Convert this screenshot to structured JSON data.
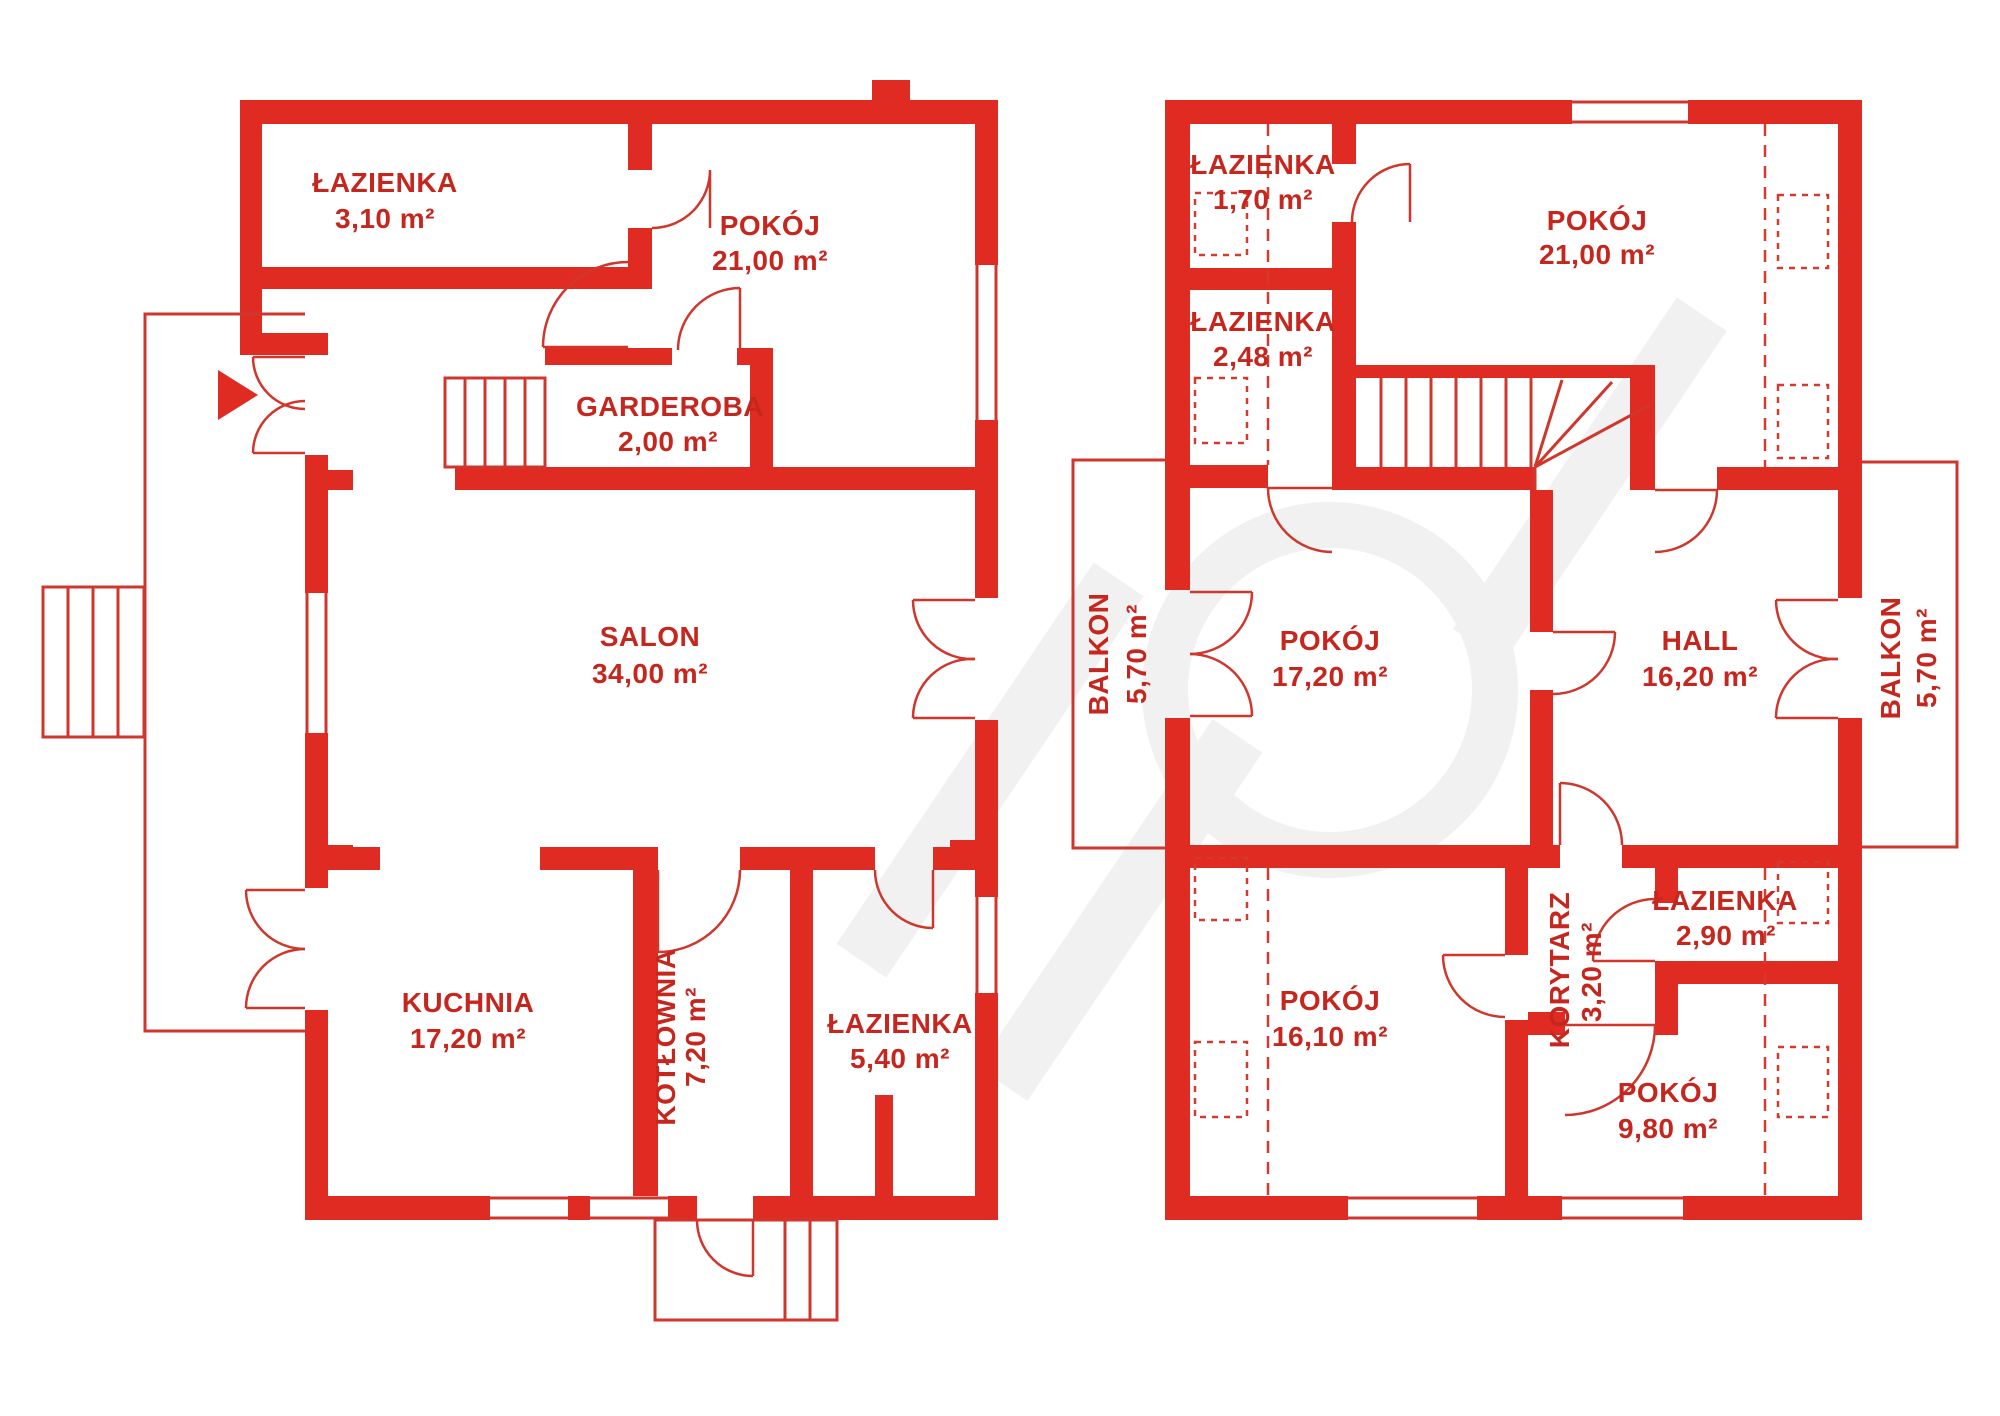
{
  "document": {
    "type": "floor-plan",
    "language": "pl"
  },
  "colors": {
    "wall": "#e02b22",
    "line": "#cf372d",
    "text": "#c5261e",
    "dashed": "#d43a30",
    "watermark": "#d9d9d9",
    "background": "#ffffff"
  },
  "floors": {
    "ground": {
      "rooms": {
        "lazienka_a": {
          "name": "ŁAZIENKA",
          "area": "3,10 m²"
        },
        "pokoj": {
          "name": "POKÓJ",
          "area": "21,00 m²"
        },
        "garderoba": {
          "name": "GARDEROBA",
          "area": "2,00 m²"
        },
        "salon": {
          "name": "SALON",
          "area": "34,00 m²"
        },
        "kuchnia": {
          "name": "KUCHNIA",
          "area": "17,20 m²"
        },
        "kotlownia": {
          "name": "KOTŁOWNIA",
          "area": "7,20 m²"
        },
        "lazienka_b": {
          "name": "ŁAZIENKA",
          "area": "5,40 m²"
        }
      }
    },
    "upper": {
      "rooms": {
        "lazienka_a": {
          "name": "ŁAZIENKA",
          "area": "1,70 m²"
        },
        "lazienka_b": {
          "name": "ŁAZIENKA",
          "area": "2,48 m²"
        },
        "pokoj_a": {
          "name": "POKÓJ",
          "area": "21,00 m²"
        },
        "balkon_a": {
          "name": "BALKON",
          "area": "5,70 m²"
        },
        "pokoj_b": {
          "name": "POKÓJ",
          "area": "17,20 m²"
        },
        "hall": {
          "name": "HALL",
          "area": "16,20 m²"
        },
        "balkon_b": {
          "name": "BALKON",
          "area": "5,70 m²"
        },
        "pokoj_c": {
          "name": "POKÓJ",
          "area": "16,10 m²"
        },
        "korytarz": {
          "name": "KORYTARZ",
          "area": "3,20 m²"
        },
        "lazienka_c": {
          "name": "ŁAZIENKA",
          "area": "2,90 m²"
        },
        "pokoj_d": {
          "name": "POKÓJ",
          "area": "9,80 m²"
        }
      }
    }
  }
}
